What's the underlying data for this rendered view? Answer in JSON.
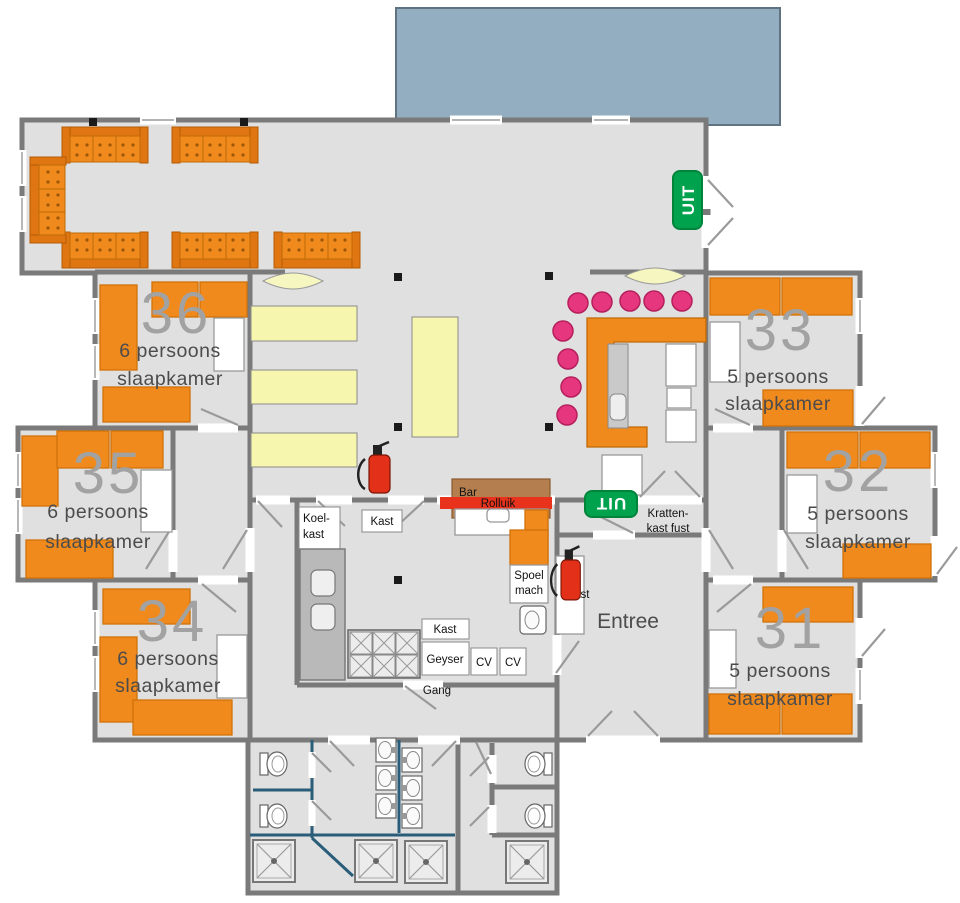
{
  "title": "Groepsaccommodatie plattegrond",
  "rooms": [
    {
      "number": "36",
      "capacity": "6 persoons",
      "type": "slaapkamer"
    },
    {
      "number": "35",
      "capacity": "6 persoons",
      "type": "slaapkamer"
    },
    {
      "number": "34",
      "capacity": "6 persoons",
      "type": "slaapkamer"
    },
    {
      "number": "33",
      "capacity": "5 persoons",
      "type": "slaapkamer"
    },
    {
      "number": "32",
      "capacity": "5 persoons",
      "type": "slaapkamer"
    },
    {
      "number": "31",
      "capacity": "5 persoons",
      "type": "slaapkamer"
    }
  ],
  "labels": {
    "entree": "Entree",
    "gang": "Gang",
    "bar": "Bar",
    "rolluik": "Rolluik",
    "koelkast_line1": "Koel-",
    "koelkast_line2": "kast",
    "kast": "Kast",
    "geyser": "Geyser",
    "cv": "CV",
    "spoel_line1": "Spoel",
    "spoel_line2": "mach",
    "kratten_line1": "Kratten-",
    "kratten_line2": "kast fust"
  },
  "exit_sign": "UIT",
  "colors": {
    "furniture_orange": "#f08a1c",
    "table_yellow": "#f6f6ae",
    "stool_pink": "#e6367e",
    "exit_green": "#00a24d",
    "terrace_blue": "#93aec1",
    "wall_gray": "#7a7a7a",
    "extinguisher_red": "#e23019",
    "bar_brown": "#b57e4e"
  }
}
